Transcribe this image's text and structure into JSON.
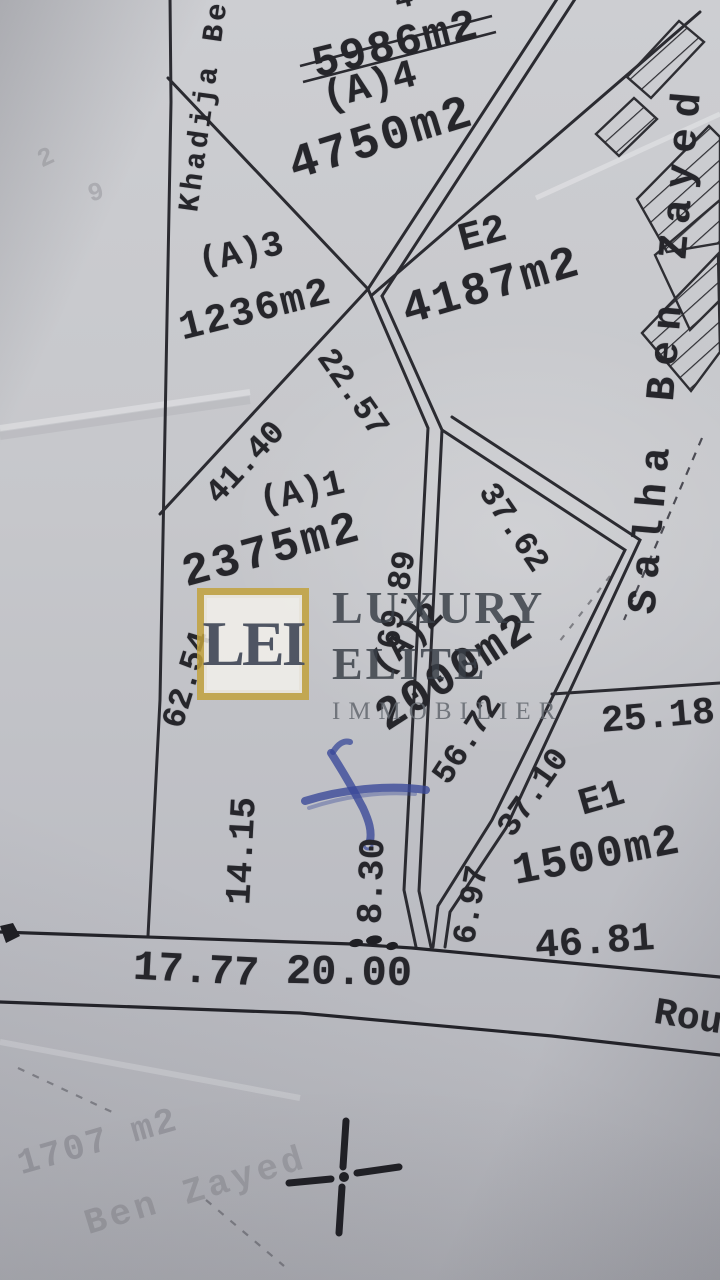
{
  "map": {
    "owners": {
      "left": "Khadija Ben",
      "right": "Salha Ben Zayed",
      "faded": "Ben Zayed"
    },
    "crossed_out_area": "5986m2",
    "partial_top_mark": "4",
    "faded_area": "1707 m2",
    "faint_marks": {
      "a": "2",
      "b": "9"
    },
    "road_label": "Rou",
    "parcels": [
      {
        "id": "(A)4",
        "area": "4750m2"
      },
      {
        "id": "(A)3",
        "area": "1236m2"
      },
      {
        "id": "E2",
        "area": "4187m2"
      },
      {
        "id": "(A)1",
        "area": "2375m2"
      },
      {
        "id": "(A)2",
        "area": "2000m2"
      },
      {
        "id": "E1",
        "area": "1500m2"
      }
    ],
    "measurements": [
      "22.57",
      "41.40",
      "37.62",
      "69.89",
      "62.54",
      "56.72",
      "25.18",
      "37.10",
      "14.15",
      "8.30",
      "6.97",
      "46.81",
      "17.77",
      "20.00"
    ]
  },
  "logo": {
    "monogram": "LEI",
    "word1": "LUXURY",
    "word2": "ELITE",
    "word3": "IMMOBILIER"
  },
  "colors": {
    "ink": "#26262b",
    "gold": "#c2a23c",
    "logo_ink": "#3a4150",
    "blue_ink": "#3e4c9e"
  }
}
